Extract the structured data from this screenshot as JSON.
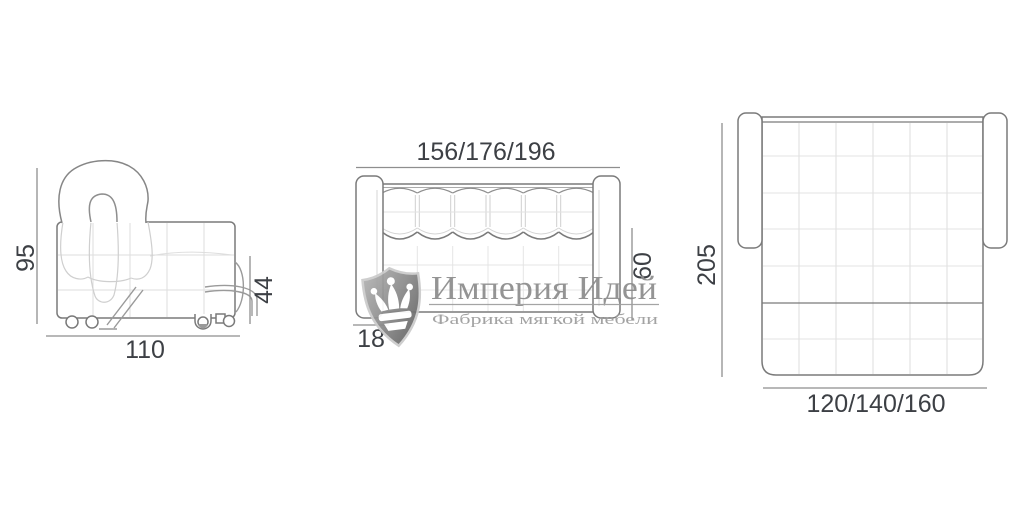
{
  "diagram": {
    "side_view": {
      "height": "95",
      "depth": "110",
      "seat_height": "44"
    },
    "front_view": {
      "width": "156/176/196",
      "base_height": "18",
      "backrest_height": "60"
    },
    "top_view": {
      "unfolded_depth": "205",
      "sleeping_width": "120/140/160"
    }
  },
  "watermark": {
    "brand": "Империя Идей",
    "tagline": "Фабрика мягкой мебели",
    "icon": "crown-shield-icon"
  },
  "colors": {
    "background": "#ffffff",
    "outline": "#7a7a7a",
    "faint_line": "#dcdcdc",
    "dimension_line": "#8e8e8e",
    "dimension_text": "#3d4045",
    "watermark_gray": "#8c8c8c"
  }
}
